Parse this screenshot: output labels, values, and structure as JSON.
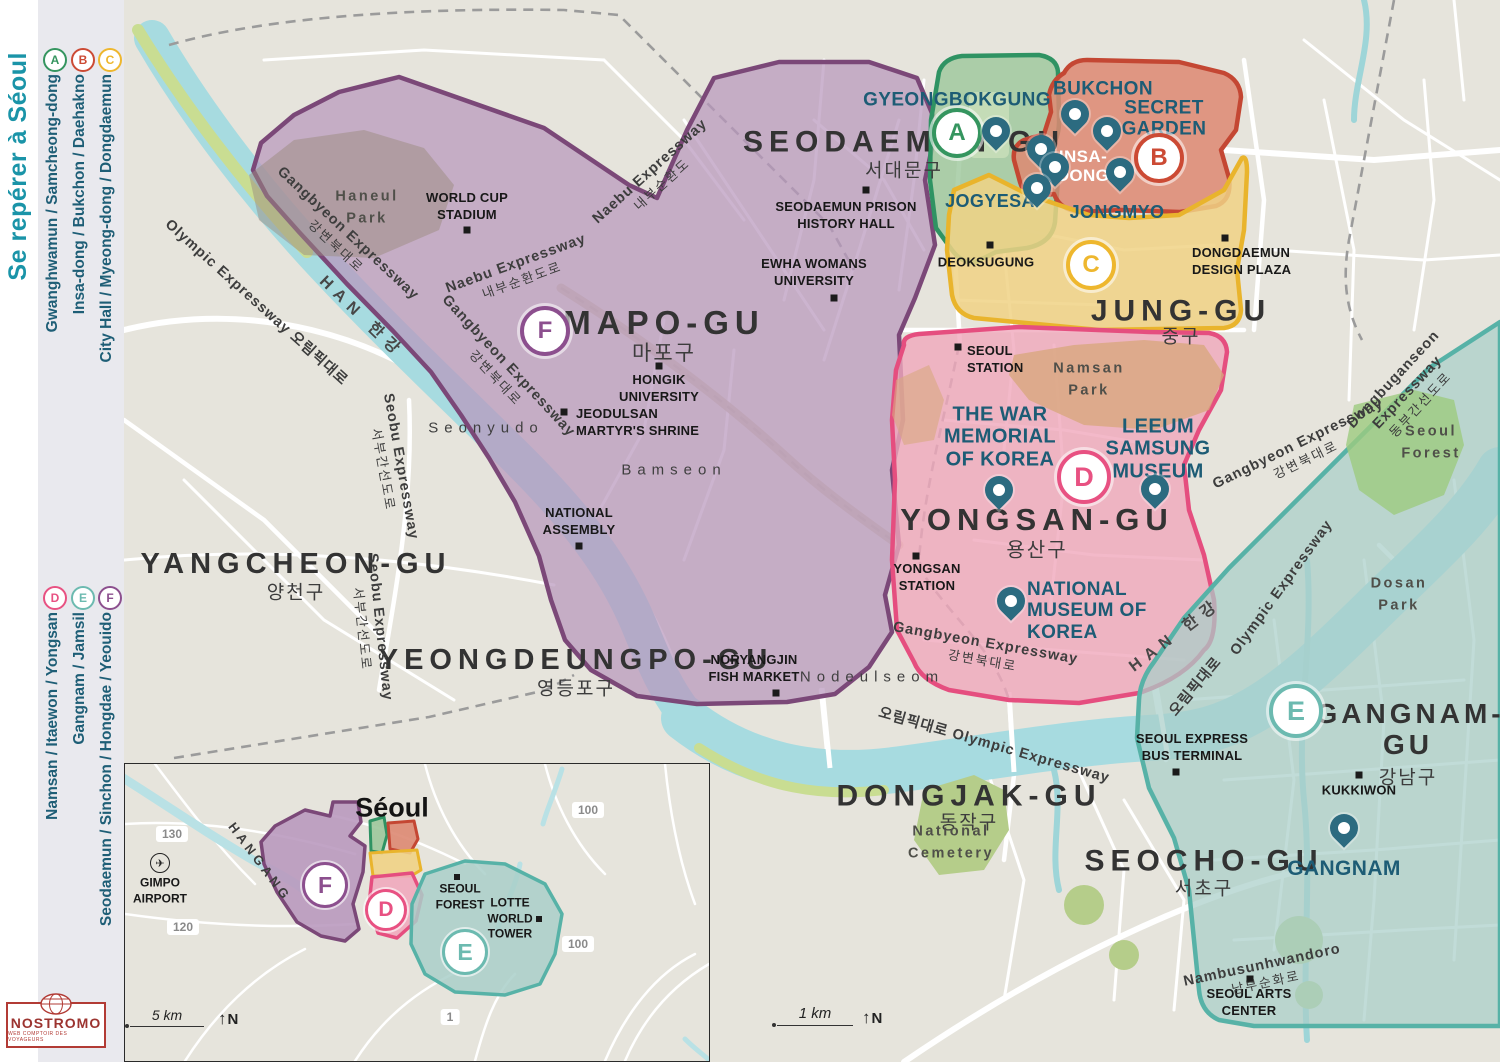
{
  "sidebar": {
    "title": "Se repérer à Séoul",
    "legend_top": [
      {
        "letter": "A",
        "label": "Gwanghwamun / Samcheong-dong"
      },
      {
        "letter": "B",
        "label": "Insa-dong / Bukchon / Daehakno"
      },
      {
        "letter": "C",
        "label": "City Hall / Myeong-dong / Dongdaemun"
      }
    ],
    "legend_bottom": [
      {
        "letter": "D",
        "label": "Namsan / Itaewon / Yongsan"
      },
      {
        "letter": "E",
        "label": "Gangnam / Jamsil"
      },
      {
        "letter": "F",
        "label": "Seodaemun / Sinchon / Hongdae / Yeouido"
      }
    ],
    "logo": {
      "name": "NOSTROMO",
      "tagline": "WEB COMPTOIR DES VOYAGEURS"
    }
  },
  "zone_colors": {
    "A": "#35955f",
    "B": "#cc4a34",
    "C": "#eeb72e",
    "D": "#e85182",
    "E": "#57b2a7",
    "F": "#7b4878"
  },
  "map": {
    "badges": [
      "A",
      "B",
      "C",
      "D",
      "E",
      "F"
    ],
    "districts": [
      {
        "name": "SEODAEMUN-GU",
        "korean": "서대문구"
      },
      {
        "name": "MAPO-GU",
        "korean": "마포구"
      },
      {
        "name": "YANGCHEON-GU",
        "korean": "양천구"
      },
      {
        "name": "YEONGDEUNGPO-GU",
        "korean": "영등포구"
      },
      {
        "name": "JUNG-GU",
        "korean": "중구"
      },
      {
        "name": "YONGSAN-GU",
        "korean": "용산구"
      },
      {
        "name": "DONGJAK-GU",
        "korean": "동작구"
      },
      {
        "name": "SEOCHO-GU",
        "korean": "서초구"
      },
      {
        "name": "GANGNAM-GU",
        "korean": "강남구"
      }
    ],
    "attractions": [
      "GYEONGBOKGUNG",
      "BUKCHON",
      "SECRET GARDEN",
      "INSA-DONG",
      "JOGYESA",
      "JONGMYO",
      "THE WAR MEMORIAL OF KOREA",
      "LEEUM SAMSUNG MUSEUM",
      "NATIONAL MUSEUM OF KOREA",
      "GANGNAM"
    ],
    "pois": [
      "WORLD CUP STADIUM",
      "SEODAEMUN PRISON HISTORY HALL",
      "EWHA WOMANS UNIVERSITY",
      "HONGIK UNIVERSITY",
      "JEODULSAN MARTYR'S SHRINE",
      "NATIONAL ASSEMBLY",
      "DEOKSUGUNG",
      "DONGDAEMUN DESIGN PLAZA",
      "SEOUL STATION",
      "YONGSAN STATION",
      "NORYANGJIN FISH MARKET",
      "SEOUL EXPRESS BUS TERMINAL",
      "KUKKIWON",
      "SEOUL ARTS CENTER"
    ],
    "parks": [
      "Haneul Park",
      "Namsan Park",
      "Seoul Forest",
      "Dosan Park",
      "National Cemetery"
    ],
    "islands": [
      "Seonyudo",
      "Bamseon",
      "Nodeulseom"
    ],
    "roads": [
      {
        "text": "Olympic Expressway 오림픽대로"
      },
      {
        "text": "Gangbyeon Expressway",
        "text2": "강변북대로"
      },
      {
        "text": "HAN 한강"
      },
      {
        "text": "Naebu Expressway",
        "text2": "내부순환도로"
      },
      {
        "text": "Gangbyeon Expressway",
        "text2": "강변북대로"
      },
      {
        "text": "Naebu Expressway",
        "text2": "내부순환도"
      },
      {
        "text": "Seobu Expressway",
        "text2": "서부간선도로"
      },
      {
        "text": "Seobu Expressway",
        "text2": "서부간선도로"
      },
      {
        "text": "Gangbyeon Expressway",
        "text2": "강변북대로"
      },
      {
        "text": "오림픽대로 Olympic Expressway"
      },
      {
        "text": "HAN 한강"
      },
      {
        "text": "오림픽대로"
      },
      {
        "text": "Olympic Expressway"
      },
      {
        "text": "Gangbyeon Expressway",
        "text2": "강변북대로"
      },
      {
        "text": "Dongbuganseon",
        "text2": "Expressway",
        "text3": "동부간선도로"
      },
      {
        "text": "Nambusunhwandoro",
        "text2": "남부순화로"
      }
    ],
    "scale": {
      "label": "1 km",
      "north": "N"
    }
  },
  "inset": {
    "title": "Séoul",
    "river": "HANGANG",
    "airport": "GIMPO AIRPORT",
    "road_numbers": [
      "130",
      "120",
      "100",
      "100",
      "1"
    ],
    "pois": [
      "SEOUL FOREST",
      "LOTTE WORLD TOWER"
    ],
    "badges": [
      "F",
      "D",
      "E"
    ],
    "scale": {
      "label": "5 km",
      "north": "N"
    }
  }
}
